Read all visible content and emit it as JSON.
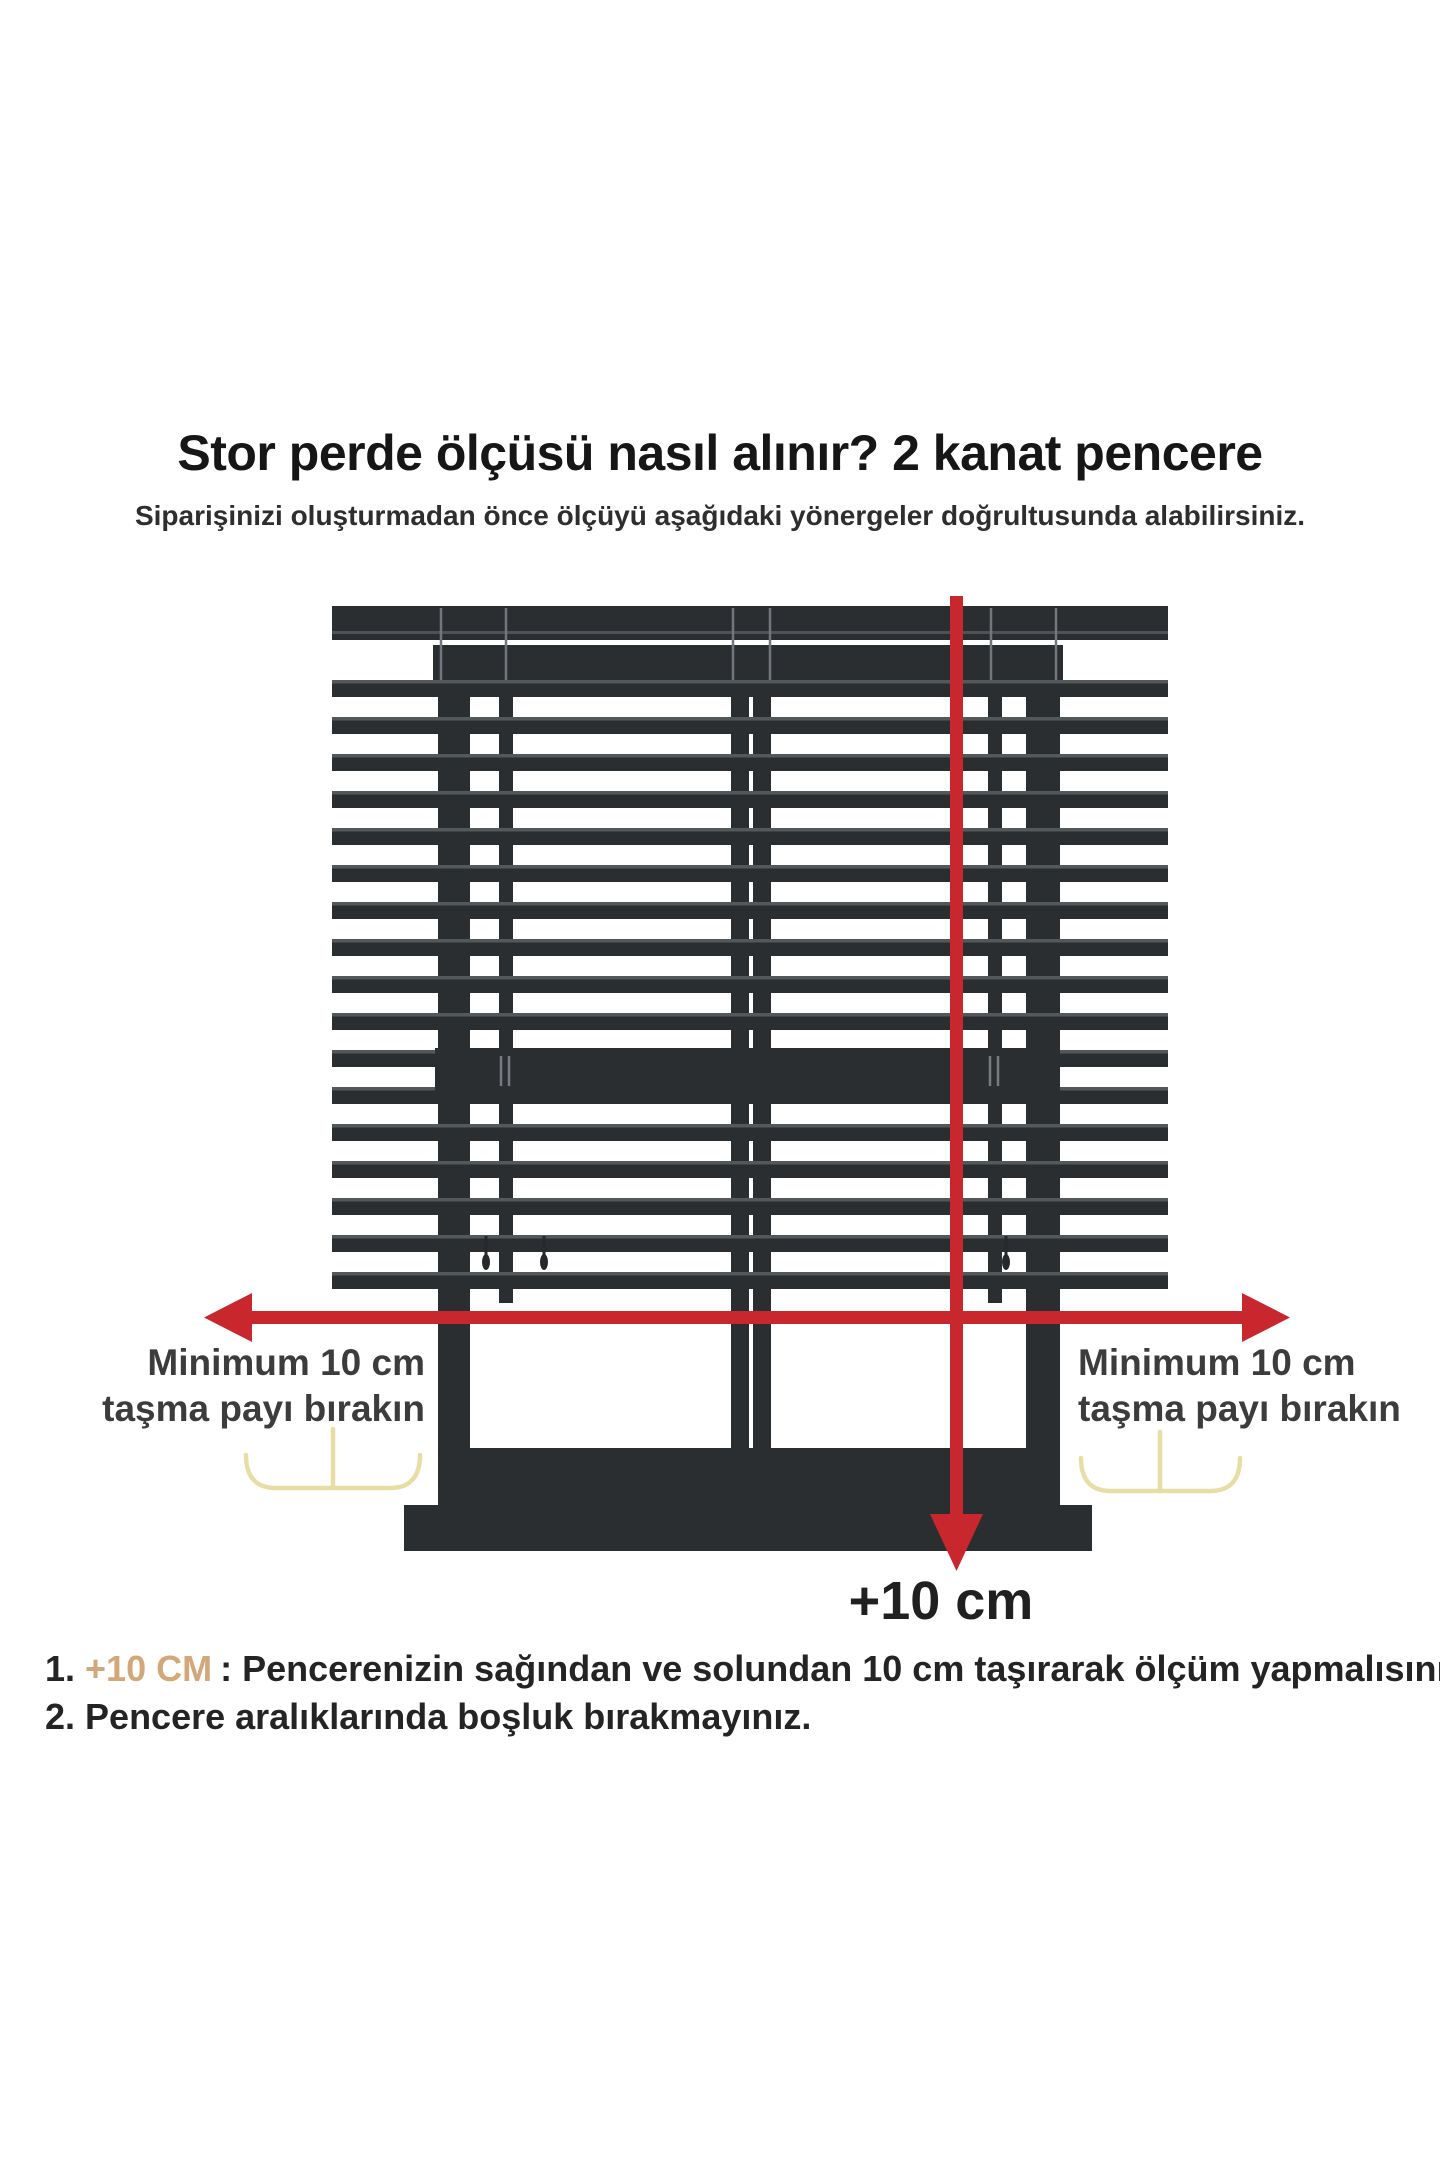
{
  "page": {
    "background_color": "#ffffff"
  },
  "header": {
    "title": "Stor perde ölçüsü nasıl alınır? 2 kanat pencere",
    "subtitle": "Siparişinizi oluşturmadan önce ölçüyü aşağıdaki yönergeler doğrultusunda alabilirsiniz."
  },
  "diagram": {
    "type": "window-blind-measurement-illustration",
    "window_panels": 2,
    "left_overhang_label": {
      "line1": "Minimum 10 cm",
      "line2": "taşma payı bırakın"
    },
    "right_overhang_label": {
      "line1": "Minimum 10 cm",
      "line2": "taşma payı bırakın"
    },
    "bottom_arrow_label": "+10 cm",
    "colors": {
      "blind_dark": "#2b2e31",
      "slat_edge": "#5b5f63",
      "arrow_red": "#c8272e",
      "bracket_yellow": "#e9dda6",
      "highlight_tan": "#d2a87b",
      "text_dark": "#242424"
    }
  },
  "instructions": {
    "item1": {
      "number": "1.",
      "highlight": "+10 CM",
      "separator": ":",
      "text": "Pencerenizin sağından ve solundan 10 cm taşırarak ölçüm yapmalısınız."
    },
    "item2": {
      "number": "2.",
      "highlight": "",
      "separator": "",
      "text": "Pencere aralıklarında boşluk bırakmayınız."
    }
  }
}
